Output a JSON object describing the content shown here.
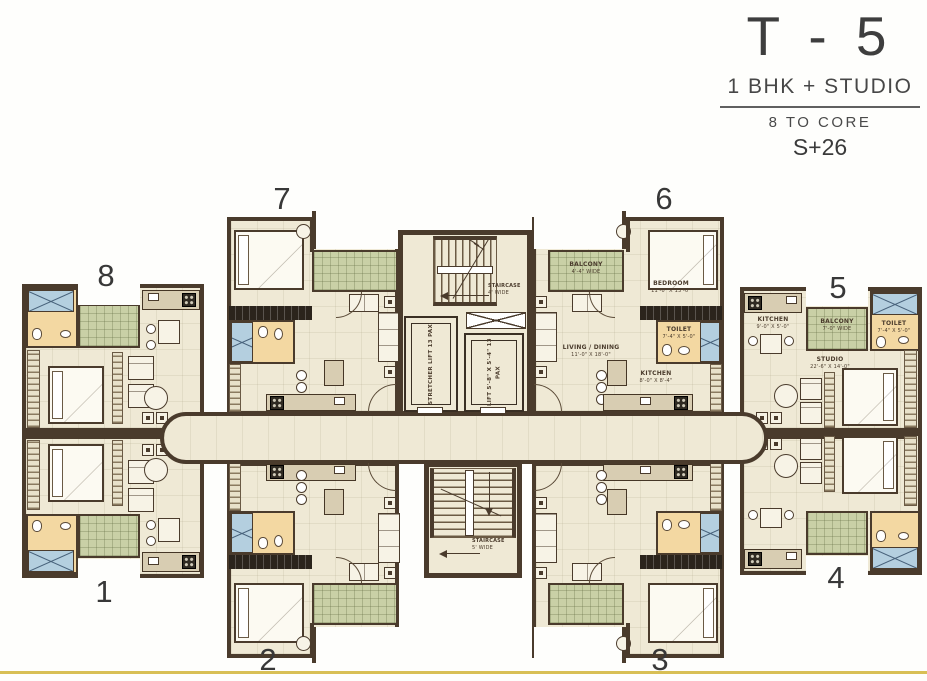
{
  "colors": {
    "wall": "#4a3b2c",
    "floor": "#efe9d5",
    "balcony": "#c9d0a6",
    "toilet_floor": "#f3d8a2",
    "shower": "#b4cfdf",
    "accent_line": "#d8bf55",
    "text": "#3e3e3e"
  },
  "title": {
    "tower": "T - 5",
    "subtitle": "1 BHK + STUDIO",
    "core_note": "8 TO CORE",
    "floors": "S+26"
  },
  "unit_numbers": {
    "u1": "1",
    "u2": "2",
    "u3": "3",
    "u4": "4",
    "u5": "5",
    "u6": "6",
    "u7": "7",
    "u8": "8"
  },
  "bhk": {
    "balcony": {
      "name": "BALCONY",
      "dim": "4'-4\" WIDE"
    },
    "bedroom": {
      "name": "BEDROOM",
      "dim": "11'-0\" X 13'-0\""
    },
    "toilet": {
      "name": "TOILET",
      "dim": "7'-4\" X 5'-0\""
    },
    "living": {
      "name": "LIVING / DINING",
      "dim": "11'-0\" X 18'-0\""
    },
    "kitchen": {
      "name": "KITCHEN",
      "dim": "8'-0\" X 8'-4\""
    }
  },
  "studio": {
    "kitchen": {
      "name": "KITCHEN",
      "dim": "9'-0\" X 5'-0\""
    },
    "balcony": {
      "name": "BALCONY",
      "dim": "7'-0\" WIDE"
    },
    "toilet": {
      "name": "TOILET",
      "dim": "7'-4\" X 5'-0\""
    },
    "studio": {
      "name": "STUDIO",
      "dim": "22'-6\" X 14'-0\""
    }
  },
  "core": {
    "stair_top": {
      "name": "STAIRCASE",
      "dim": "4' WIDE"
    },
    "stair_bottom": {
      "name": "STAIRCASE",
      "dim": "5' WIDE"
    },
    "lift_stretcher": "STRETCHER LIFT 13 PAX",
    "lift_passenger": "LIFT 5'-8\" X 5'-4\" 13 PAX"
  }
}
